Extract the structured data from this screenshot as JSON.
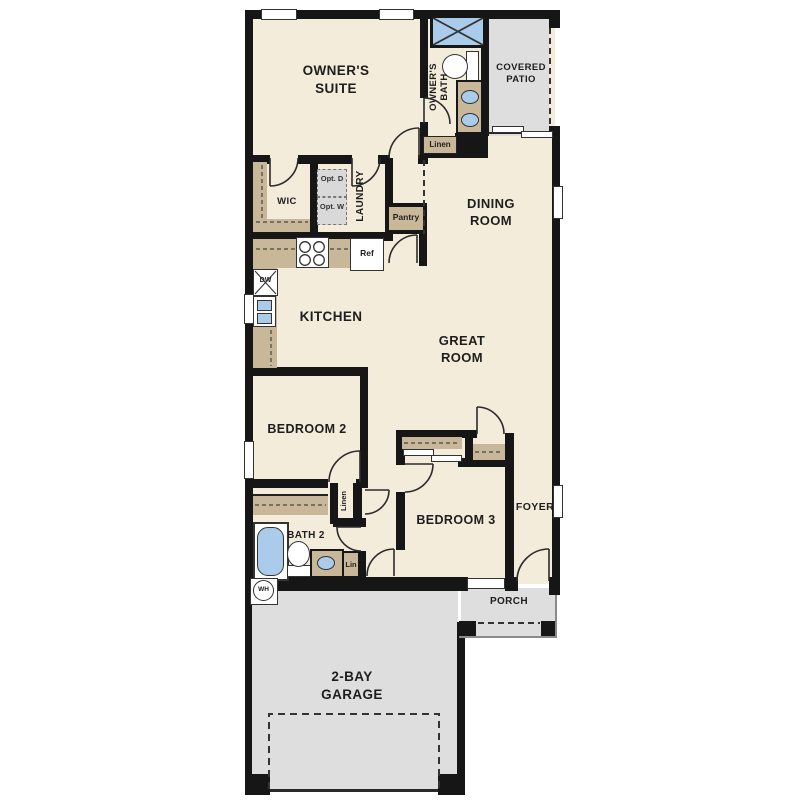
{
  "plan_title": "single-story floor plan",
  "colors": {
    "wall": "#161616",
    "floor_interior": "#f4ecda",
    "floor_outdoor": "#dedede",
    "counter_tan": "#c9b79a",
    "fixture_blue": "#aacbea",
    "appliance_gray": "#d9d9d9"
  },
  "rooms": {
    "owners_suite": "OWNER'S SUITE",
    "owners_bath": "OWNER'S BATH",
    "covered_patio": "COVERED PATIO",
    "dining_room": "DINING ROOM",
    "wic": "WIC",
    "laundry": "LAUNDRY",
    "kitchen": "KITCHEN",
    "great_room": "GREAT ROOM",
    "bedroom2": "BEDROOM 2",
    "bedroom3": "BEDROOM 3",
    "foyer": "FOYER",
    "bath2": "BATH 2",
    "porch": "PORCH",
    "garage": "2-BAY GARAGE"
  },
  "fixtures": {
    "pantry": "Pantry",
    "ref": "Ref",
    "dw": "DW",
    "wh": "WH",
    "linen_bath": "Linen",
    "linen_hall": "Linen",
    "lin": "Lin",
    "opt_d": "Opt. D",
    "opt_w": "Opt. W"
  }
}
